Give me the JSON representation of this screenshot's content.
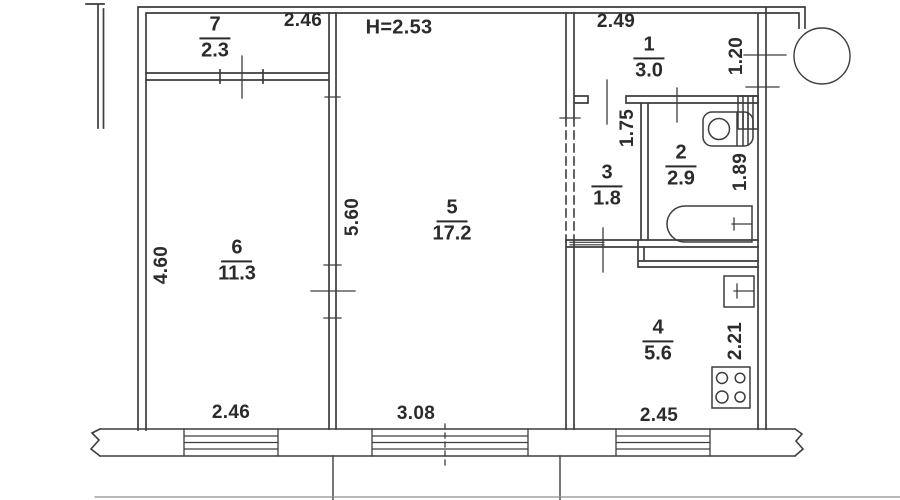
{
  "plan": {
    "height_note": "Н=2.53",
    "rooms": {
      "r1": {
        "number": "1",
        "area": "3.0"
      },
      "r2": {
        "number": "2",
        "area": "2.9"
      },
      "r3": {
        "number": "3",
        "area": "1.8"
      },
      "r4": {
        "number": "4",
        "area": "5.6"
      },
      "r5": {
        "number": "5",
        "area": "17.2"
      },
      "r6": {
        "number": "6",
        "area": "11.3"
      },
      "r7": {
        "number": "7",
        "area": "2.3"
      }
    },
    "dimensions": {
      "top_left": "2.46",
      "top_right": "2.49",
      "entry_width": "1.20",
      "left_height": "4.60",
      "room5_height": "5.60",
      "corridor": "1.75",
      "bath_height": "1.89",
      "kitchen_height": "2.21",
      "bottom_left": "2.46",
      "bottom_middle": "3.08",
      "bottom_right": "2.45"
    },
    "fixtures": {
      "toilet": "toilet-icon",
      "bathtub": "bathtub-icon",
      "kitchen_sink": "kitchen-sink-icon",
      "stove": "stove-icon",
      "vent_shaft": "vent-shaft-icon",
      "vent_circle": "vent-circle-icon"
    },
    "colors": {
      "line": "#3d3d3d",
      "background": "#ffffff",
      "text": "#2b2b2b"
    }
  }
}
